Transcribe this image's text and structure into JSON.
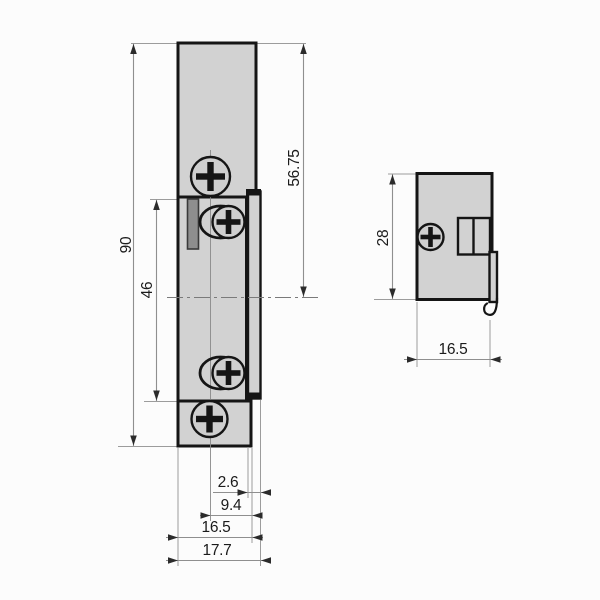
{
  "dimensions": {
    "front": {
      "overall_height": "90",
      "keeper_height": "46",
      "top_to_axis": "56.75",
      "lip_width": "2.6",
      "axis_to_edge": "9.4",
      "plate_width": "16.5",
      "overall_width": "17.7"
    },
    "side": {
      "body_height": "28",
      "body_depth": "16.5"
    }
  },
  "colors": {
    "background": "#fcfcfc",
    "part_fill": "#d2d2d2",
    "screw_fill": "#cfcfcf",
    "keeper_dark_fill": "#8e8e8e",
    "outline": "#151515",
    "dimension_line": "#8f8f8f",
    "dimension_text": "#1b1b1b"
  }
}
